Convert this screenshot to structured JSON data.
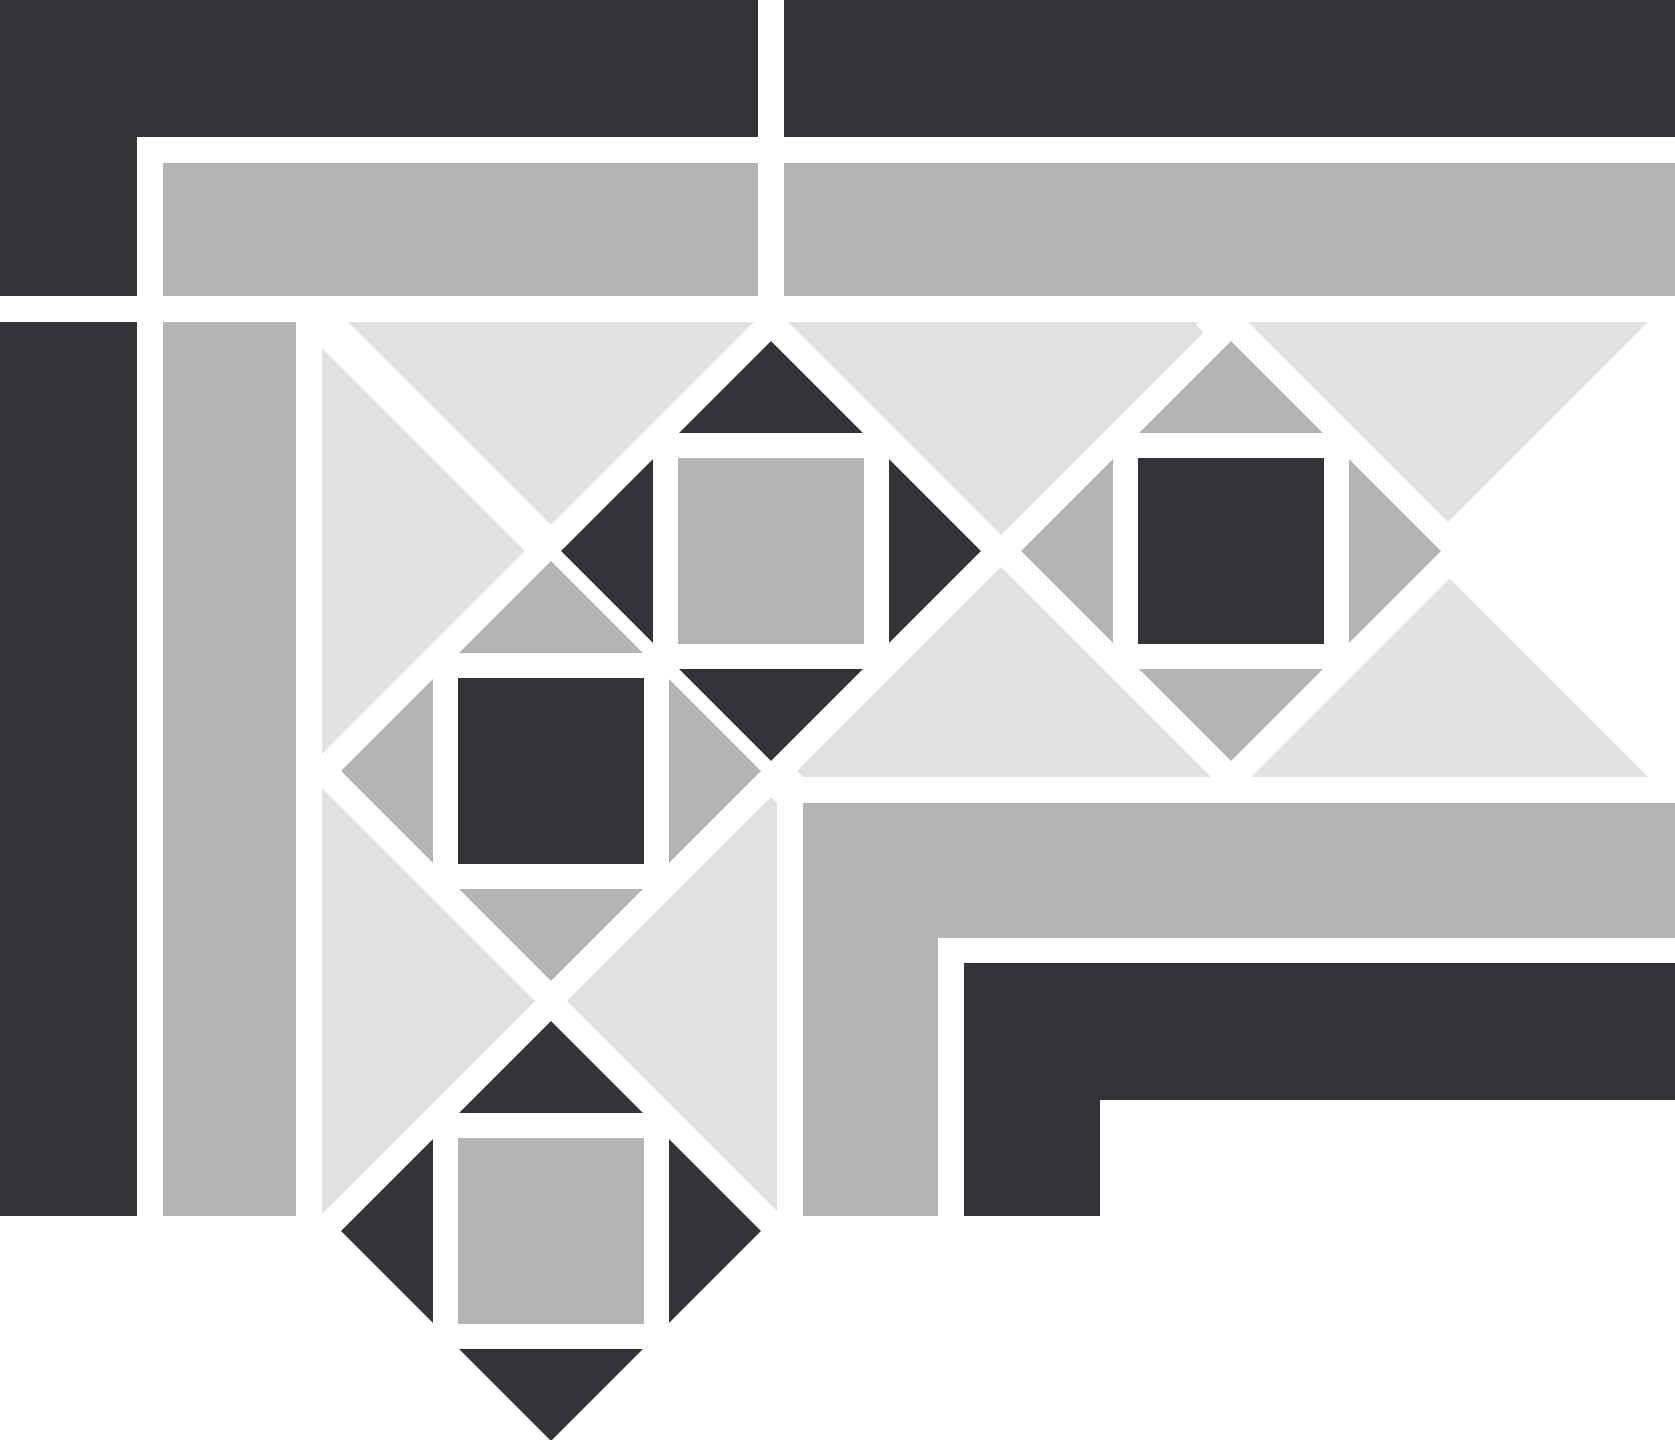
{
  "canvas": {
    "width": 1675,
    "height": 1440,
    "background": "#ffffff"
  },
  "colors": {
    "dark": "#333438",
    "gray": "#b2b3b5",
    "light": "#e0e1e3",
    "white": "#ffffff"
  },
  "pattern": {
    "description": "Grayscale geometric tile border corner: outer dark L-frame, gray L-band, diagonal diamond border band with four square-in-diamond motifs, inner gray L-band and inner dark L-band on white ground",
    "motif_centers": [
      [
        771,
        551
      ],
      [
        1231,
        551
      ],
      [
        551,
        771
      ],
      [
        551,
        1231
      ]
    ],
    "diamond_radius": 210,
    "stripe_width": 26
  },
  "shapes": [
    {
      "name": "band-background-top",
      "color": "light",
      "points": [
        [
          322,
          322
        ],
        [
          1675,
          322
        ],
        [
          1675,
          777
        ],
        [
          322,
          777
        ]
      ]
    },
    {
      "name": "band-background-left",
      "color": "light",
      "points": [
        [
          322,
          322
        ],
        [
          777,
          322
        ],
        [
          777,
          1236
        ],
        [
          322,
          1236
        ]
      ]
    },
    {
      "name": "corner-diagonal-stripe",
      "color": "white",
      "points": [
        [
          287,
          313
        ],
        [
          313,
          287
        ],
        [
          813,
          787
        ],
        [
          787,
          813
        ]
      ]
    },
    {
      "name": "band-end-right-lower-stripe",
      "color": "white",
      "points": [
        [
          1196,
          325
        ],
        [
          1222,
          299
        ],
        [
          1701,
          778
        ],
        [
          1675,
          804
        ]
      ]
    },
    {
      "name": "band-end-right-upper-stripe",
      "color": "white",
      "points": [
        [
          1222,
          748
        ],
        [
          1248,
          774
        ],
        [
          1701,
          321
        ],
        [
          1675,
          295
        ]
      ]
    },
    {
      "name": "band-end-right-wedge",
      "color": "white",
      "points": [
        [
          1455,
          551
        ],
        [
          1675,
          336
        ],
        [
          1675,
          766
        ]
      ]
    },
    {
      "name": "motif-1-white-diamond",
      "color": "white",
      "points": [
        [
          771,
          305
        ],
        [
          1017,
          551
        ],
        [
          771,
          797
        ],
        [
          525,
          551
        ]
      ]
    },
    {
      "name": "motif-2-white-diamond",
      "color": "white",
      "points": [
        [
          1231,
          305
        ],
        [
          1477,
          551
        ],
        [
          1231,
          797
        ],
        [
          985,
          551
        ]
      ]
    },
    {
      "name": "motif-3-white-diamond",
      "color": "white",
      "points": [
        [
          551,
          525
        ],
        [
          797,
          771
        ],
        [
          551,
          1017
        ],
        [
          305,
          771
        ]
      ]
    },
    {
      "name": "motif-4-white-diamond",
      "color": "white",
      "points": [
        [
          551,
          985
        ],
        [
          797,
          1231
        ],
        [
          551,
          1477
        ],
        [
          305,
          1231
        ]
      ]
    },
    {
      "name": "motif-1-center-square",
      "color": "gray",
      "points": [
        [
          678,
          458
        ],
        [
          864,
          458
        ],
        [
          864,
          644
        ],
        [
          678,
          644
        ]
      ]
    },
    {
      "name": "motif-1-triangle-north",
      "color": "dark",
      "points": [
        [
          679,
          433
        ],
        [
          863,
          433
        ],
        [
          771,
          341
        ]
      ]
    },
    {
      "name": "motif-1-triangle-south",
      "color": "dark",
      "points": [
        [
          679,
          669
        ],
        [
          863,
          669
        ],
        [
          771,
          761
        ]
      ]
    },
    {
      "name": "motif-1-triangle-west",
      "color": "dark",
      "points": [
        [
          653,
          459
        ],
        [
          653,
          643
        ],
        [
          561,
          551
        ]
      ]
    },
    {
      "name": "motif-1-triangle-east",
      "color": "dark",
      "points": [
        [
          889,
          459
        ],
        [
          889,
          643
        ],
        [
          981,
          551
        ]
      ]
    },
    {
      "name": "motif-2-center-square",
      "color": "dark",
      "points": [
        [
          1138,
          458
        ],
        [
          1324,
          458
        ],
        [
          1324,
          644
        ],
        [
          1138,
          644
        ]
      ]
    },
    {
      "name": "motif-2-triangle-north",
      "color": "gray",
      "points": [
        [
          1139,
          433
        ],
        [
          1323,
          433
        ],
        [
          1231,
          341
        ]
      ]
    },
    {
      "name": "motif-2-triangle-south",
      "color": "gray",
      "points": [
        [
          1139,
          669
        ],
        [
          1323,
          669
        ],
        [
          1231,
          761
        ]
      ]
    },
    {
      "name": "motif-2-triangle-west",
      "color": "gray",
      "points": [
        [
          1113,
          459
        ],
        [
          1113,
          643
        ],
        [
          1021,
          551
        ]
      ]
    },
    {
      "name": "motif-2-triangle-east",
      "color": "gray",
      "points": [
        [
          1349,
          459
        ],
        [
          1349,
          643
        ],
        [
          1441,
          551
        ]
      ]
    },
    {
      "name": "motif-3-center-square",
      "color": "dark",
      "points": [
        [
          458,
          678
        ],
        [
          644,
          678
        ],
        [
          644,
          864
        ],
        [
          458,
          864
        ]
      ]
    },
    {
      "name": "motif-3-triangle-north",
      "color": "gray",
      "points": [
        [
          459,
          653
        ],
        [
          643,
          653
        ],
        [
          551,
          561
        ]
      ]
    },
    {
      "name": "motif-3-triangle-south",
      "color": "gray",
      "points": [
        [
          459,
          889
        ],
        [
          643,
          889
        ],
        [
          551,
          981
        ]
      ]
    },
    {
      "name": "motif-3-triangle-west",
      "color": "gray",
      "points": [
        [
          433,
          679
        ],
        [
          433,
          863
        ],
        [
          341,
          771
        ]
      ]
    },
    {
      "name": "motif-3-triangle-east",
      "color": "gray",
      "points": [
        [
          669,
          679
        ],
        [
          669,
          863
        ],
        [
          761,
          771
        ]
      ]
    },
    {
      "name": "motif-4-center-square",
      "color": "gray",
      "points": [
        [
          458,
          1138
        ],
        [
          644,
          1138
        ],
        [
          644,
          1324
        ],
        [
          458,
          1324
        ]
      ]
    },
    {
      "name": "motif-4-triangle-north",
      "color": "dark",
      "points": [
        [
          459,
          1113
        ],
        [
          643,
          1113
        ],
        [
          551,
          1021
        ]
      ]
    },
    {
      "name": "motif-4-triangle-south",
      "color": "dark",
      "points": [
        [
          459,
          1349
        ],
        [
          643,
          1349
        ],
        [
          551,
          1441
        ]
      ]
    },
    {
      "name": "motif-4-triangle-west",
      "color": "dark",
      "points": [
        [
          433,
          1139
        ],
        [
          433,
          1323
        ],
        [
          341,
          1231
        ]
      ]
    },
    {
      "name": "motif-4-triangle-east",
      "color": "dark",
      "points": [
        [
          669,
          1139
        ],
        [
          669,
          1323
        ],
        [
          761,
          1231
        ]
      ]
    },
    {
      "name": "outer-dark-top-band-left",
      "color": "dark",
      "points": [
        [
          0,
          0
        ],
        [
          758,
          0
        ],
        [
          758,
          137
        ],
        [
          0,
          137
        ]
      ]
    },
    {
      "name": "outer-dark-top-band-right",
      "color": "dark",
      "points": [
        [
          784,
          0
        ],
        [
          1675,
          0
        ],
        [
          1675,
          137
        ],
        [
          784,
          137
        ]
      ]
    },
    {
      "name": "outer-dark-corner-block",
      "color": "dark",
      "points": [
        [
          0,
          0
        ],
        [
          137,
          0
        ],
        [
          137,
          296
        ],
        [
          0,
          296
        ]
      ]
    },
    {
      "name": "outer-gray-band-left",
      "color": "gray",
      "points": [
        [
          163,
          163
        ],
        [
          758,
          163
        ],
        [
          758,
          296
        ],
        [
          163,
          296
        ]
      ]
    },
    {
      "name": "outer-gray-band-right",
      "color": "gray",
      "points": [
        [
          784,
          163
        ],
        [
          1675,
          163
        ],
        [
          1675,
          296
        ],
        [
          784,
          296
        ]
      ]
    },
    {
      "name": "outer-dark-left-column",
      "color": "dark",
      "points": [
        [
          0,
          322
        ],
        [
          137,
          322
        ],
        [
          137,
          1216
        ],
        [
          0,
          1216
        ]
      ]
    },
    {
      "name": "outer-gray-left-column",
      "color": "gray",
      "points": [
        [
          163,
          322
        ],
        [
          296,
          322
        ],
        [
          296,
          1216
        ],
        [
          163,
          1216
        ]
      ]
    },
    {
      "name": "inner-gray-l-band",
      "color": "gray",
      "points": [
        [
          803,
          803
        ],
        [
          1675,
          803
        ],
        [
          1675,
          938
        ],
        [
          938,
          938
        ],
        [
          938,
          1216
        ],
        [
          803,
          1216
        ]
      ]
    },
    {
      "name": "inner-dark-l-band",
      "color": "dark",
      "points": [
        [
          964,
          963
        ],
        [
          1675,
          963
        ],
        [
          1675,
          1100
        ],
        [
          1100,
          1100
        ],
        [
          1100,
          1216
        ],
        [
          964,
          1216
        ]
      ]
    }
  ]
}
